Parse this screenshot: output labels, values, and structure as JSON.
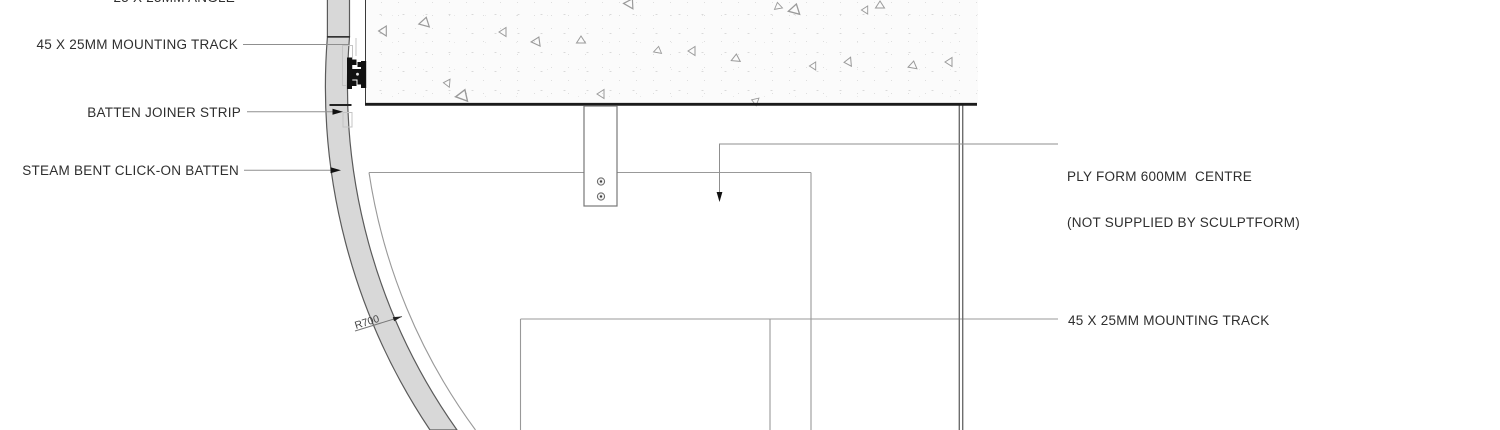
{
  "drawing": {
    "title_context": "Steam bent click-on batten mounting detail",
    "labels": {
      "angle_top": "25 X 25MM ANGLE",
      "mounting_track_left": "45 X 25MM MOUNTING TRACK",
      "batten_joiner": "BATTEN JOINER STRIP",
      "steam_bent_batten": "STEAM BENT CLICK-ON BATTEN",
      "ply_form_line1": "PLY FORM 600MM  CENTRE",
      "ply_form_line2": "(NOT SUPPLIED BY SCULPTFORM)",
      "mounting_track_right": "45 X 25MM MOUNTING TRACK",
      "radius_dim": "R700"
    },
    "colors": {
      "batten_fill": "#d8d8d8",
      "batten_outline": "#5a5a5a",
      "slab_edge": "#1b1b1b",
      "thin_line": "#999999",
      "leader_line": "#8f8f8f",
      "track_profile": "#111111",
      "text": "#2e2e2e"
    }
  }
}
